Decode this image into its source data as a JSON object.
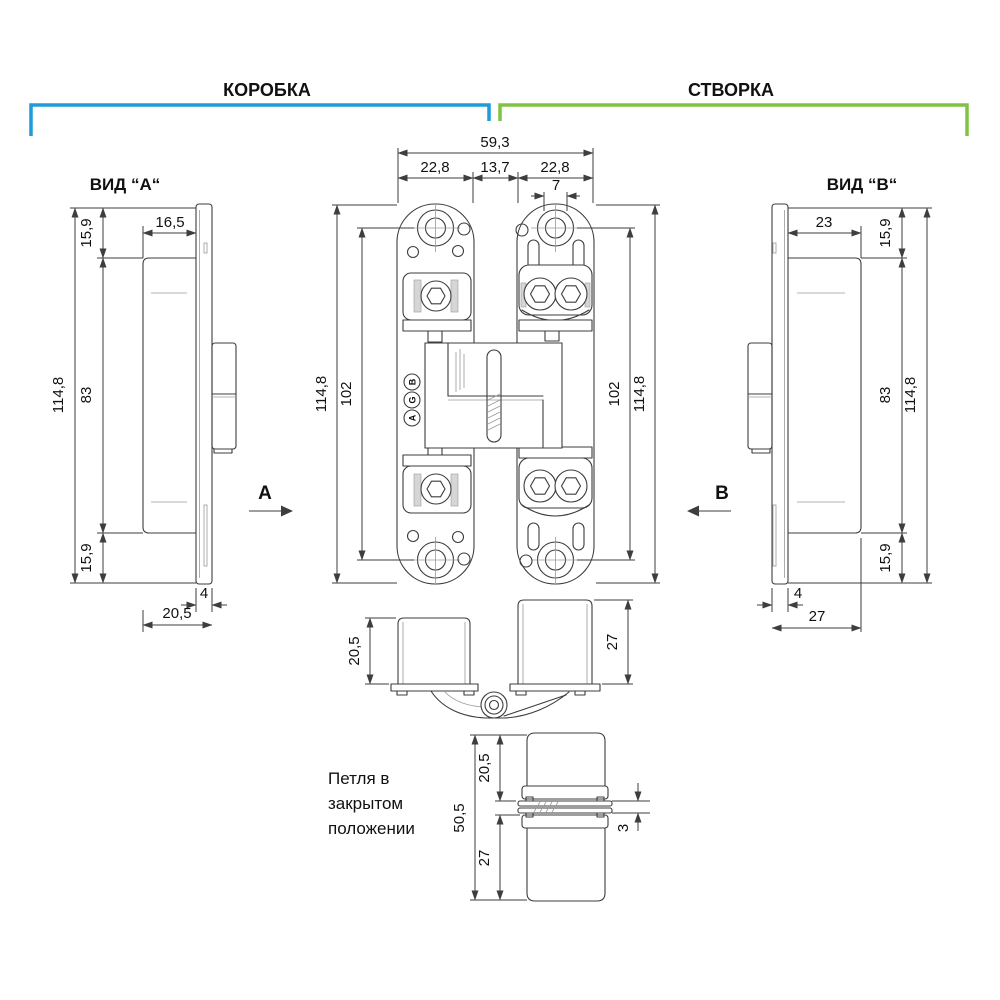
{
  "colors": {
    "frame_bracket": "#1f9cd9",
    "leaf_bracket": "#80c342",
    "line": "#3c3c3c",
    "text": "#111111"
  },
  "header": {
    "frame_label": "КОРОБКА",
    "leaf_label": "СТВОРКА"
  },
  "view_a": {
    "title": "ВИД “А“",
    "arrow": "А",
    "dims": {
      "top_offset": "15,9",
      "plate_width": "16,5",
      "body_height": "83",
      "total_height": "114,8",
      "bottom_offset": "15,9",
      "lip": "4",
      "depth": "20,5"
    }
  },
  "view_b": {
    "title": "ВИД “В“",
    "arrow": "В",
    "dims": {
      "plate_width": "23",
      "top_offset": "15,9",
      "body_height": "83",
      "total_height": "114,8",
      "bottom_offset": "15,9",
      "lip": "4",
      "depth": "27"
    }
  },
  "front_view": {
    "brand_letters": [
      "A",
      "G",
      "B"
    ],
    "dims": {
      "total_width": "59,3",
      "frame_plate": "22,8",
      "center_gap": "13,7",
      "leaf_plate": "22,8",
      "adjustment": "7",
      "height": "114,8",
      "holes_span": "102"
    }
  },
  "open_view": {
    "dims": {
      "frame_depth": "20,5",
      "leaf_depth": "27"
    }
  },
  "closed_view": {
    "caption": {
      "line1": "Петля в",
      "line2": "закрытом",
      "line3": "положении"
    },
    "dims": {
      "total": "50,5",
      "frame_side": "20,5",
      "leaf_side": "27",
      "gap": "3"
    }
  }
}
